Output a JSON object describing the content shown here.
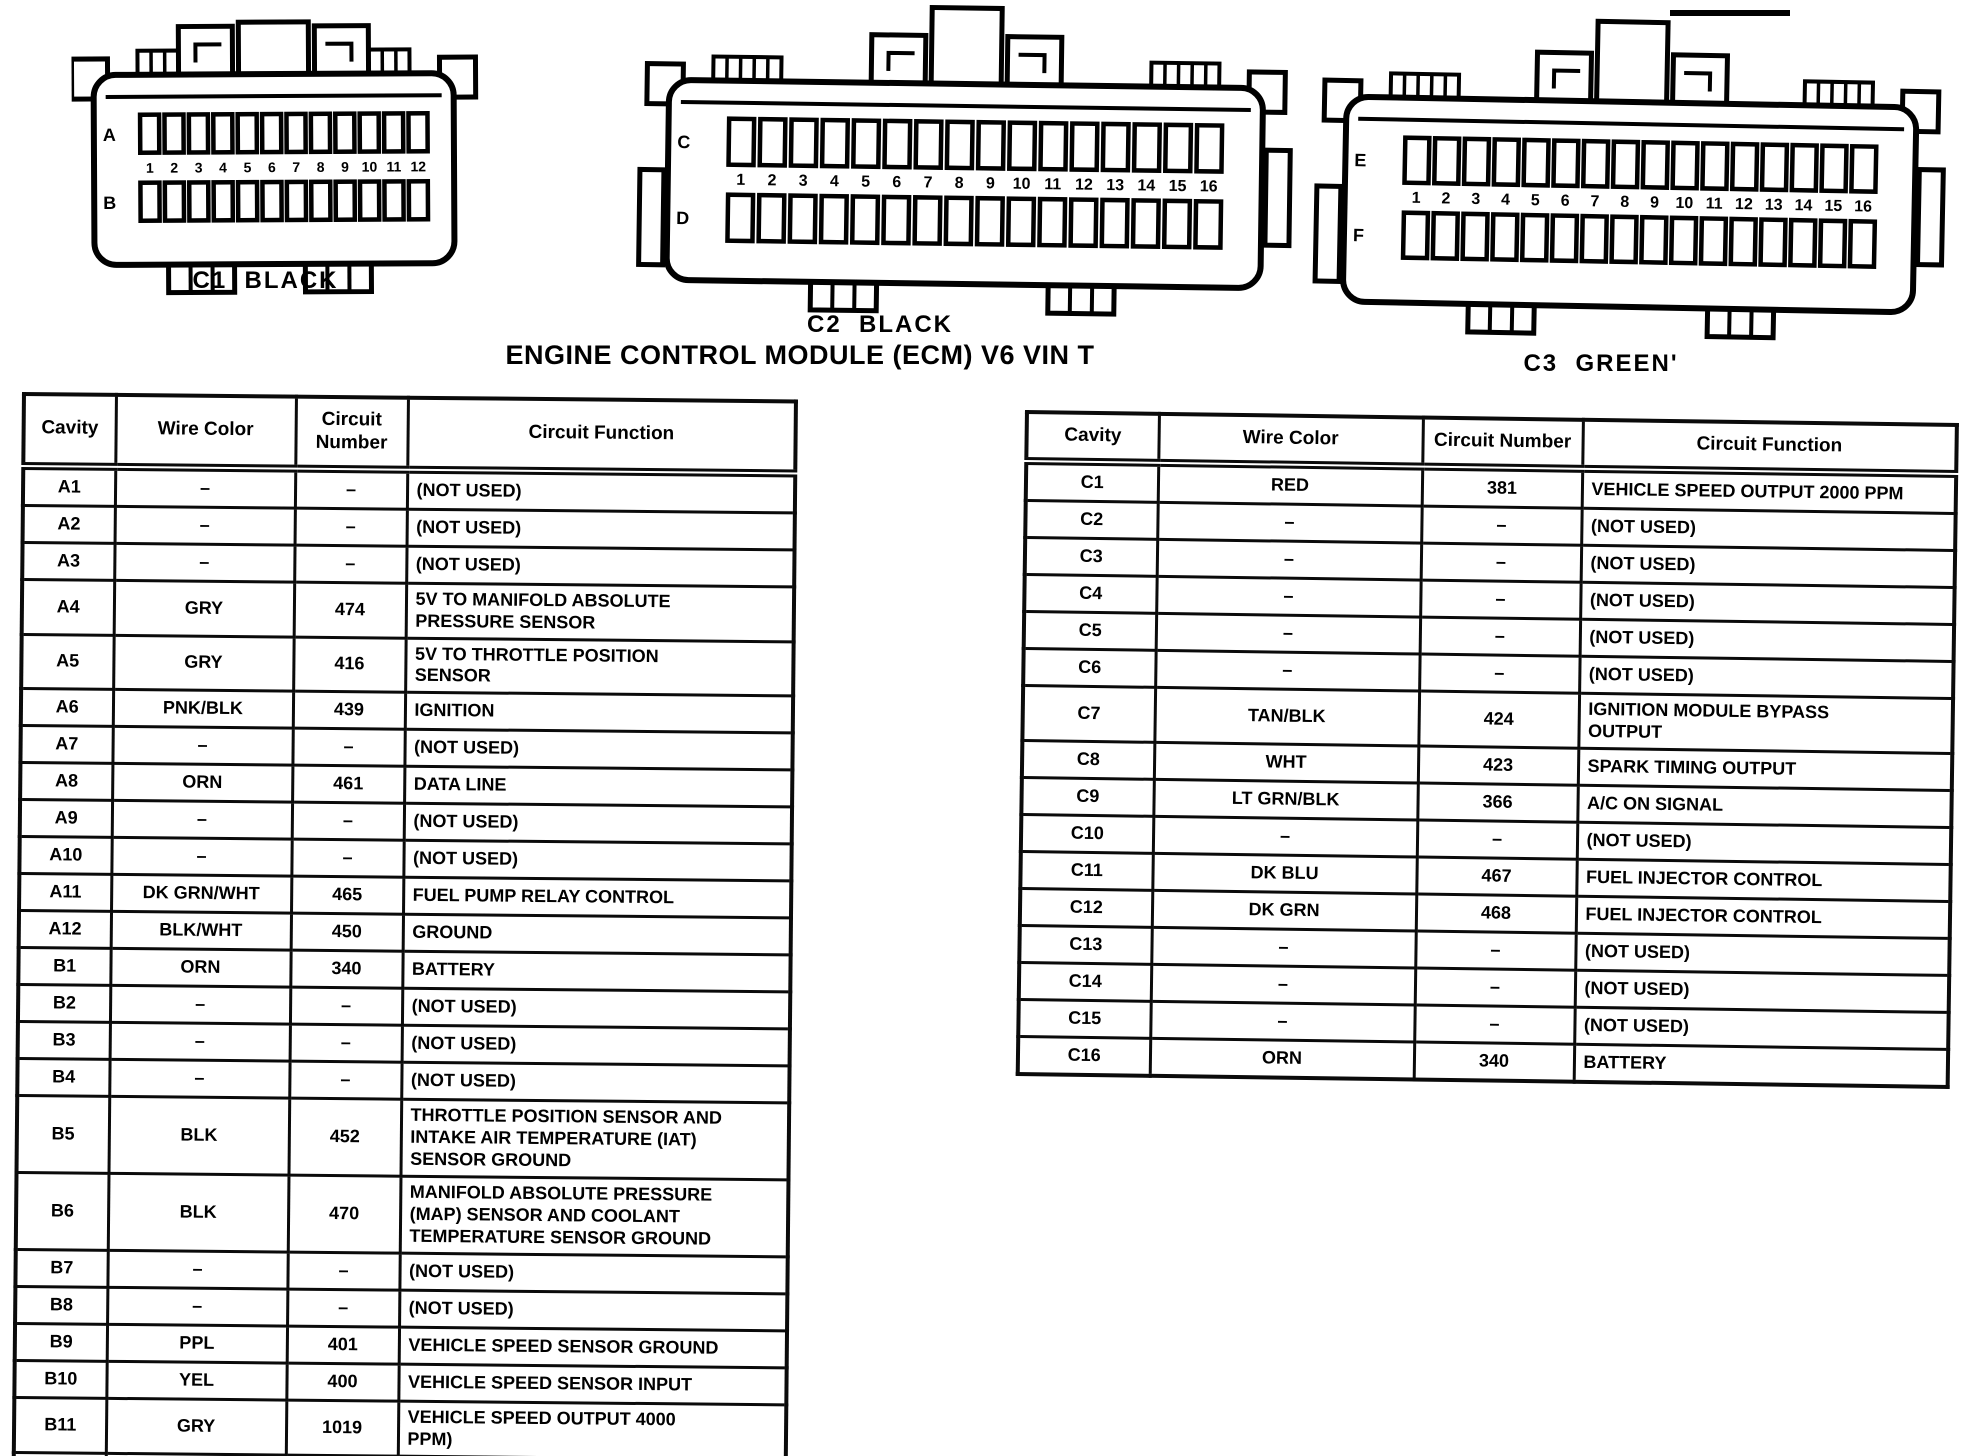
{
  "title": "ENGINE CONTROL MODULE (ECM) V6 VIN T",
  "connectors": [
    {
      "label": "C1  BLACK",
      "rows": [
        "A",
        "B"
      ],
      "pins": 12
    },
    {
      "label": "C2  BLACK",
      "rows": [
        "C",
        "D"
      ],
      "pins": 16
    },
    {
      "label": "C3  GREEN'",
      "rows": [
        "E",
        "F"
      ],
      "pins": 16
    }
  ],
  "headers": [
    "Cavity",
    "Wire Color",
    "Circuit Number",
    "Circuit Function"
  ],
  "left_table": {
    "rows": [
      {
        "cavity": "A1",
        "color": "–",
        "number": "–",
        "function": "(NOT USED)"
      },
      {
        "cavity": "A2",
        "color": "–",
        "number": "–",
        "function": "(NOT USED)"
      },
      {
        "cavity": "A3",
        "color": "–",
        "number": "–",
        "function": "(NOT USED)"
      },
      {
        "cavity": "A4",
        "color": "GRY",
        "number": "474",
        "function": "5V TO MANIFOLD ABSOLUTE\nPRESSURE SENSOR"
      },
      {
        "cavity": "A5",
        "color": "GRY",
        "number": "416",
        "function": "5V TO THROTTLE POSITION\nSENSOR"
      },
      {
        "cavity": "A6",
        "color": "PNK/BLK",
        "number": "439",
        "function": "IGNITION"
      },
      {
        "cavity": "A7",
        "color": "–",
        "number": "–",
        "function": "(NOT USED)"
      },
      {
        "cavity": "A8",
        "color": "ORN",
        "number": "461",
        "function": "DATA LINE"
      },
      {
        "cavity": "A9",
        "color": "–",
        "number": "–",
        "function": "(NOT USED)"
      },
      {
        "cavity": "A10",
        "color": "–",
        "number": "–",
        "function": "(NOT USED)"
      },
      {
        "cavity": "A11",
        "color": "DK GRN/WHT",
        "number": "465",
        "function": "FUEL PUMP RELAY CONTROL"
      },
      {
        "cavity": "A12",
        "color": "BLK/WHT",
        "number": "450",
        "function": "GROUND"
      },
      {
        "cavity": "B1",
        "color": "ORN",
        "number": "340",
        "function": "BATTERY"
      },
      {
        "cavity": "B2",
        "color": "–",
        "number": "–",
        "function": "(NOT USED)"
      },
      {
        "cavity": "B3",
        "color": "–",
        "number": "–",
        "function": "(NOT USED)"
      },
      {
        "cavity": "B4",
        "color": "–",
        "number": "–",
        "function": "(NOT USED)"
      },
      {
        "cavity": "B5",
        "color": "BLK",
        "number": "452",
        "function": "THROTTLE POSITION SENSOR AND\nINTAKE AIR TEMPERATURE (IAT)\nSENSOR GROUND"
      },
      {
        "cavity": "B6",
        "color": "BLK",
        "number": "470",
        "function": "MANIFOLD ABSOLUTE PRESSURE\n(MAP) SENSOR AND COOLANT\nTEMPERATURE SENSOR GROUND"
      },
      {
        "cavity": "B7",
        "color": "–",
        "number": "–",
        "function": "(NOT USED)"
      },
      {
        "cavity": "B8",
        "color": "–",
        "number": "–",
        "function": "(NOT USED)"
      },
      {
        "cavity": "B9",
        "color": "PPL",
        "number": "401",
        "function": "VEHICLE SPEED SENSOR GROUND"
      },
      {
        "cavity": "B10",
        "color": "YEL",
        "number": "400",
        "function": "VEHICLE SPEED SENSOR INPUT"
      },
      {
        "cavity": "B11",
        "color": "GRY",
        "number": "1019",
        "function": "VEHICLE SPEED OUTPUT 4000\nPPM)"
      },
      {
        "cavity": "B12",
        "color": "–",
        "number": "–",
        "function": "(NOT USED)"
      }
    ]
  },
  "right_table": {
    "rows": [
      {
        "cavity": "C1",
        "color": "RED",
        "number": "381",
        "function": "VEHICLE SPEED OUTPUT 2000 PPM"
      },
      {
        "cavity": "C2",
        "color": "–",
        "number": "–",
        "function": "(NOT USED)"
      },
      {
        "cavity": "C3",
        "color": "–",
        "number": "–",
        "function": "(NOT USED)"
      },
      {
        "cavity": "C4",
        "color": "–",
        "number": "–",
        "function": "(NOT USED)"
      },
      {
        "cavity": "C5",
        "color": "–",
        "number": "–",
        "function": "(NOT USED)"
      },
      {
        "cavity": "C6",
        "color": "–",
        "number": "–",
        "function": "(NOT USED)"
      },
      {
        "cavity": "C7",
        "color": "TAN/BLK",
        "number": "424",
        "function": "IGNITION MODULE BYPASS\nOUTPUT"
      },
      {
        "cavity": "C8",
        "color": "WHT",
        "number": "423",
        "function": "SPARK TIMING OUTPUT"
      },
      {
        "cavity": "C9",
        "color": "LT GRN/BLK",
        "number": "366",
        "function": "A/C ON SIGNAL"
      },
      {
        "cavity": "C10",
        "color": "–",
        "number": "–",
        "function": "(NOT USED)"
      },
      {
        "cavity": "C11",
        "color": "DK BLU",
        "number": "467",
        "function": "FUEL INJECTOR CONTROL"
      },
      {
        "cavity": "C12",
        "color": "DK GRN",
        "number": "468",
        "function": "FUEL INJECTOR CONTROL"
      },
      {
        "cavity": "C13",
        "color": "–",
        "number": "–",
        "function": "(NOT USED)"
      },
      {
        "cavity": "C14",
        "color": "–",
        "number": "–",
        "function": "(NOT USED)"
      },
      {
        "cavity": "C15",
        "color": "–",
        "number": "–",
        "function": "(NOT USED)"
      },
      {
        "cavity": "C16",
        "color": "ORN",
        "number": "340",
        "function": "BATTERY"
      }
    ]
  }
}
